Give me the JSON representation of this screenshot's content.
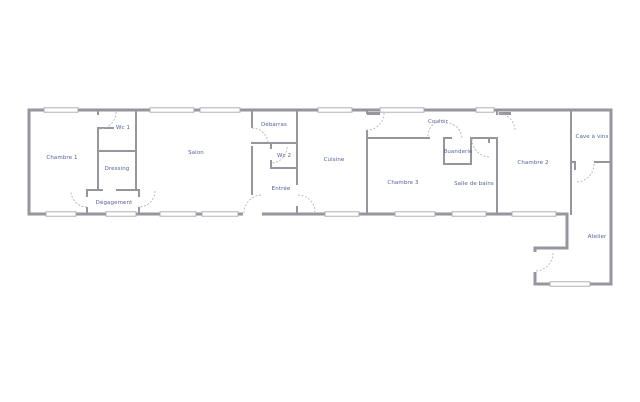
{
  "plan": {
    "type": "floorplan",
    "colors": {
      "background": "#ffffff",
      "wall": "#96969e",
      "window_stroke": "#a8a8b0",
      "door_arc": "#b6b6be",
      "label": "#56609a"
    },
    "rooms": [
      {
        "id": "chambre-1",
        "label": "Chambre 1",
        "x": 62,
        "y": 158
      },
      {
        "id": "wc-1",
        "label": "Wc 1",
        "x": 123,
        "y": 128
      },
      {
        "id": "dressing",
        "label": "Dressing",
        "x": 117,
        "y": 169
      },
      {
        "id": "degagement",
        "label": "Dégagement",
        "x": 114,
        "y": 203
      },
      {
        "id": "salon",
        "label": "Salon",
        "x": 196,
        "y": 153
      },
      {
        "id": "debarras",
        "label": "Débarras",
        "x": 274,
        "y": 125
      },
      {
        "id": "wc-2",
        "label": "Wc 2",
        "x": 284,
        "y": 156
      },
      {
        "id": "entree",
        "label": "Entrée",
        "x": 281,
        "y": 189
      },
      {
        "id": "cuisine",
        "label": "Cuisine",
        "x": 334,
        "y": 160
      },
      {
        "id": "couloir",
        "label": "Couloir",
        "x": 438,
        "y": 122
      },
      {
        "id": "chambre-3",
        "label": "Chambre 3",
        "x": 403,
        "y": 183
      },
      {
        "id": "buanderie",
        "label": "Buanderie",
        "x": 458,
        "y": 152
      },
      {
        "id": "salle-de-bains",
        "label": "Salle de bains",
        "x": 474,
        "y": 184
      },
      {
        "id": "chambre-2",
        "label": "Chambre 2",
        "x": 533,
        "y": 163
      },
      {
        "id": "cave-a-vins",
        "label": "Cave à vins",
        "x": 592,
        "y": 137
      },
      {
        "id": "atelier",
        "label": "Atelier",
        "x": 597,
        "y": 237
      }
    ],
    "geometry": {
      "outline": "M29,110 H611 V284 H535 V248 H567 V214 H29 Z",
      "outline_stroke_width": 3,
      "walls": [
        [
          97,
          110,
          2,
          5
        ],
        [
          97,
          127,
          17,
          2
        ],
        [
          97,
          127,
          2,
          64
        ],
        [
          97,
          150,
          40,
          2
        ],
        [
          135,
          110,
          2,
          81
        ],
        [
          86,
          189,
          17,
          2
        ],
        [
          116,
          189,
          24,
          2
        ],
        [
          86,
          189,
          2,
          8
        ],
        [
          86,
          207,
          2,
          8
        ],
        [
          138,
          189,
          2,
          8
        ],
        [
          138,
          207,
          2,
          8
        ],
        [
          251,
          110,
          2,
          18
        ],
        [
          251,
          146,
          2,
          49
        ],
        [
          251,
          142,
          47,
          2
        ],
        [
          270,
          142,
          2,
          7
        ],
        [
          270,
          160,
          2,
          9
        ],
        [
          270,
          167,
          28,
          2
        ],
        [
          296,
          110,
          2,
          75
        ],
        [
          296,
          206,
          2,
          9
        ],
        [
          366,
          110,
          2,
          4
        ],
        [
          366,
          130,
          2,
          85
        ],
        [
          366,
          137,
          64,
          2
        ],
        [
          443,
          137,
          9,
          2
        ],
        [
          443,
          137,
          2,
          28
        ],
        [
          470,
          137,
          2,
          28
        ],
        [
          443,
          163,
          29,
          2
        ],
        [
          472,
          137,
          18,
          2
        ],
        [
          488,
          137,
          2,
          6
        ],
        [
          490,
          137,
          8,
          2
        ],
        [
          496,
          137,
          2,
          78
        ],
        [
          496,
          110,
          2,
          5
        ],
        [
          570,
          110,
          2,
          105
        ],
        [
          572,
          161,
          4,
          2
        ],
        [
          574,
          163,
          2,
          7
        ],
        [
          594,
          161,
          17,
          2
        ]
      ],
      "door_gaps": [
        [
          243,
          210,
          19,
          7
        ],
        [
          531,
          252,
          7,
          20
        ]
      ],
      "windows": [
        [
          44,
          110,
          34
        ],
        [
          150,
          110,
          44
        ],
        [
          200,
          110,
          40
        ],
        [
          318,
          110,
          34
        ],
        [
          380,
          110,
          44
        ],
        [
          476,
          110,
          18
        ],
        [
          46,
          214,
          30
        ],
        [
          106,
          214,
          30
        ],
        [
          160,
          214,
          36
        ],
        [
          202,
          214,
          36
        ],
        [
          325,
          214,
          34
        ],
        [
          395,
          214,
          40
        ],
        [
          452,
          214,
          34
        ],
        [
          512,
          214,
          44
        ],
        [
          550,
          284,
          40
        ]
      ],
      "door_leaves": [
        [
          367,
          112,
          13,
          3
        ],
        [
          499,
          112,
          12,
          3
        ]
      ],
      "door_arcs": [
        "M116,112 A17,17 0 0 1 99,129",
        "M87,207 A16,16 0 0 1 71,191",
        "M155,191 A16,16 0 0 1 139,207",
        "M252,128 A16,16 0 0 1 268,144",
        "M287,147 A16,16 0 0 1 271,163",
        "M244,213 A18,18 0 0 1 262,195",
        "M298,195 A17,17 0 0 1 315,212",
        "M384,113 A17,17 0 0 1 367,130",
        "M428,136 A16,16 0 0 1 444,120",
        "M446,123 A16,16 0 0 1 462,139",
        "M472,139 A18,18 0 0 0 490,157",
        "M497,113 A18,18 0 0 1 515,131",
        "M594,164 A18,18 0 0 1 576,182",
        "M553,253 A18,18 0 0 1 535,271"
      ]
    }
  }
}
